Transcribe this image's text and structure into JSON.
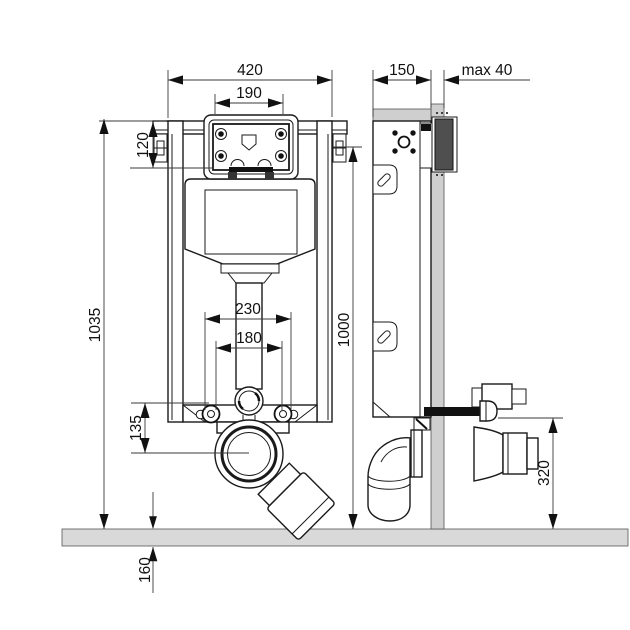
{
  "drawing": {
    "subject": "Concealed WC cistern mounting frame - dimensioned installation drawing",
    "units": "mm",
    "views": [
      "front elevation",
      "side section"
    ]
  },
  "dims": {
    "frame_width": "420",
    "plate_opening_width": "190",
    "frame_depth": "150",
    "max_wall_offset": "max 40",
    "top_section_height": "120",
    "frame_height": "1035",
    "installation_height": "1000",
    "fixing_span_outer": "230",
    "fixing_span_inner": "180",
    "outlet_centre_height": "135",
    "connection_height": "320",
    "below_floor_depth": "160"
  },
  "colors": {
    "line": "#1a1a1a",
    "wall_fill": "#cfcfcf",
    "floor_fill": "#d9d9d9",
    "bracket_dark": "#4f4f4f",
    "background": "#ffffff"
  }
}
